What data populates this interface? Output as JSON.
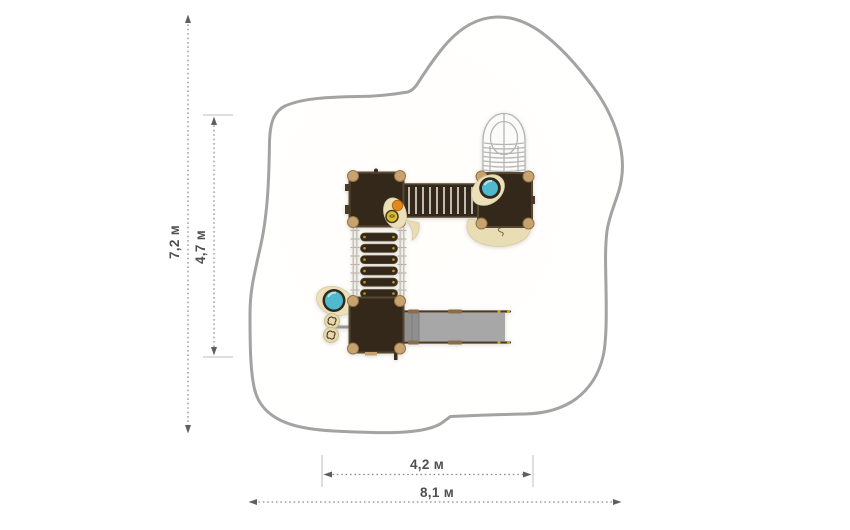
{
  "drawing": {
    "type": "playground-equipment-top-view-dimension-plan",
    "dim": {
      "total_height": "7,2 м",
      "inner_height": "4,7 м",
      "inner_width": "4,2 м",
      "total_width": "8,1 м"
    },
    "colors": {
      "safety_zone_outline": "#a3a3a3",
      "dimension_line": "#8a8a8a",
      "dimension_label": "#4f4f4f",
      "platform_dark_brown": "#33281a",
      "platform_edge": "#554732",
      "corner_post_tan": "#c9a36f",
      "panel_beige": "#ece0ba",
      "bubble_teal": "#4fb9cd",
      "accent_orange": "#e0891e",
      "accent_yellow": "#d9bf39",
      "slide_gray": "#a7a7a7",
      "metal_gray": "#bdb9af"
    },
    "equipment_parts": [
      "platform",
      "stair-bridge",
      "spiral-tube-slide",
      "flexible-step-bridge",
      "straight-slide",
      "teal-bubble-panel",
      "flower-climb-panel",
      "play-wheel"
    ]
  }
}
